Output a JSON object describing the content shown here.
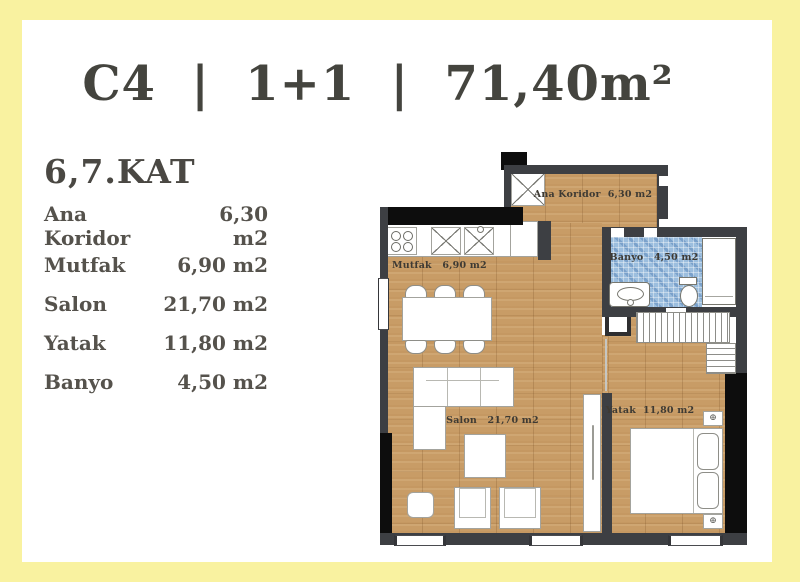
{
  "header": {
    "title": "C4  |  1+1  |  71,40m²",
    "floor": "6,7.KAT"
  },
  "room_list": [
    {
      "name": "Ana Koridor",
      "area": "6,30 m2"
    },
    {
      "name": "Mutfak",
      "area": "6,90 m2"
    },
    {
      "name": "Salon",
      "area": "21,70 m2"
    },
    {
      "name": "Yatak",
      "area": "11,80 m2"
    },
    {
      "name": "Banyo",
      "area": "4,50 m2"
    }
  ],
  "plan": {
    "labels": {
      "ana_koridor": "Ana Koridor  6,30 m2",
      "mutfak": "Mutfak   6,90 m2",
      "banyo": "Banyo   4,50 m2",
      "salon": "Salon   21,70 m2",
      "yatak": "Yatak  11,80 m2"
    }
  },
  "colors": {
    "frame_yellow": "#F9F2A0",
    "background_white": "#FFFFFF",
    "wall_gray": "#3D3F43",
    "wall_black": "#0D0D0D",
    "wood_floor": "#C89C66",
    "bathroom_tile_blue": "#9CBEDE",
    "title_text": "#44443E",
    "list_text": "#55524C",
    "plan_text": "#3E3A33"
  }
}
